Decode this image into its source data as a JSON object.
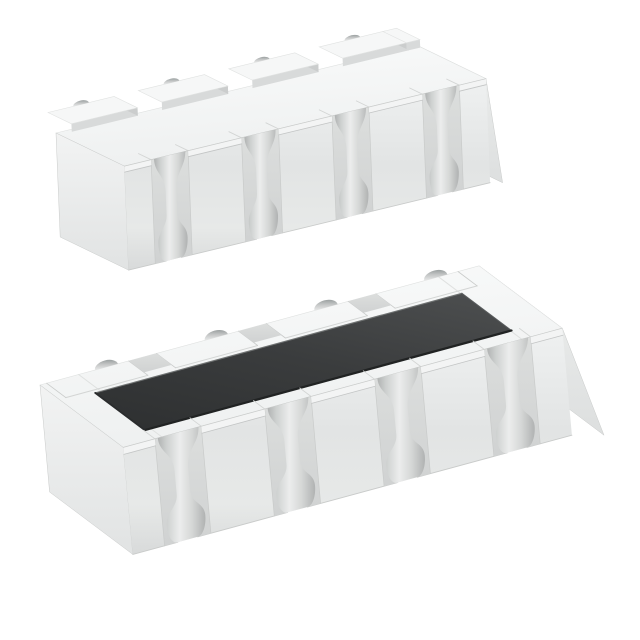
{
  "background": "#ffffff",
  "scene": {
    "type": "product-render",
    "subject": "Two white ceramic castellated resistor array packages (8 convex terminals), one shown bottom-side up, one shown top-side up with dark resistive element",
    "colors": {
      "top_face_light": "#fafbfb",
      "top_face_dark": "#eef0f0",
      "end_face_light": "#f2f3f3",
      "end_face_dark": "#e1e3e3",
      "end_face_right_light": "#edefee",
      "end_face_right_dark": "#dddfdf",
      "front_top": "#eff1f1",
      "front_mid": "#e2e4e4",
      "front_low": "#e7e9e8",
      "front_bottom": "#d8dada",
      "gap_light": "#dcdedd",
      "gap_dark": "#d0d2d2",
      "ledge": "#f3f4f4",
      "ledge_line": "#c3c5c5",
      "groove_edge": "#b0b2b2",
      "groove_soft": "#cdd0cf",
      "groove_highlight": "#eceded",
      "groove_soft2": "#d5d7d6",
      "arch_deep": "#acaeae",
      "arch_mid": "#d4d6d6",
      "arch_near": "#eceeee",
      "pad_top": "#f6f7f7",
      "pad_wall": "#d8dada",
      "pad_side": "#cbcdcd",
      "pad_edge_line": "#e0e2e1",
      "notch_deep": "#9aa0a0",
      "notch_mid": "#c4c6c6",
      "notch_light": "#e8e9e9",
      "step_line": "#d3d5d4",
      "fine_line": "#c9cbca",
      "top_line": "#dfe1e0",
      "element_light": "#4b4d4e",
      "element_mid": "#3a3c3d",
      "element_dark": "#2f3132",
      "element_edge_dark": "#212323",
      "element_edge_light": "#6f7272",
      "element_edge_right": "#595c5d",
      "element_edge_left": "#2a2c2d",
      "hole": "#ffffff"
    },
    "chips": [
      {
        "name": "resistor-array-bottom-view",
        "view_label": "bottom mounting side up",
        "origin": [
          56,
          133
        ],
        "axes": {
          "u": [
            0.972,
            -0.235
          ],
          "v": [
            0.9,
            0.436
          ],
          "w": [
            0.04,
            1
          ]
        },
        "length": 372,
        "width": 76,
        "height": 104,
        "terminals_per_side": 4,
        "ledge": 6,
        "end_skew": 0.12,
        "groove": {
          "top_r": 16,
          "channel_half": 5.5,
          "bottom_r": 15,
          "hole_r": 7.5,
          "squash": 0.4
        },
        "pads": {
          "raised": true,
          "w": 68,
          "d": 22,
          "lip": 4,
          "rise": 8,
          "nr": 8,
          "nky": 0.5,
          "shift": 0,
          "notch_off": 0
        },
        "left_end": true,
        "right_end": true,
        "top_lines": false
      },
      {
        "name": "resistor-array-top-view",
        "view_label": "top side with resistive element",
        "origin": [
          40,
          385
        ],
        "axes": {
          "u": [
            0.965,
            -0.262
          ],
          "v": [
            0.8,
            0.6
          ],
          "w": [
            0.09,
            1
          ]
        },
        "length": 455,
        "width": 104,
        "height": 107,
        "terminals_per_side": 4,
        "ledge": 7,
        "end_skew": 0.3,
        "groove": {
          "top_r": 21,
          "channel_half": 7,
          "bottom_r": 20,
          "hole_r": 10,
          "squash": 0.52
        },
        "pads": {
          "raised": false,
          "w": 85,
          "d": 24,
          "lip": 0,
          "rise": 0,
          "nr": 12,
          "nky": 0.6,
          "shift": -7.5,
          "notch_off": 12
        },
        "element": {
          "t0": 34,
          "t1": 414,
          "s0": 28,
          "s1": 90
        },
        "left_end": true,
        "right_end": true,
        "top_lines": true
      }
    ]
  }
}
